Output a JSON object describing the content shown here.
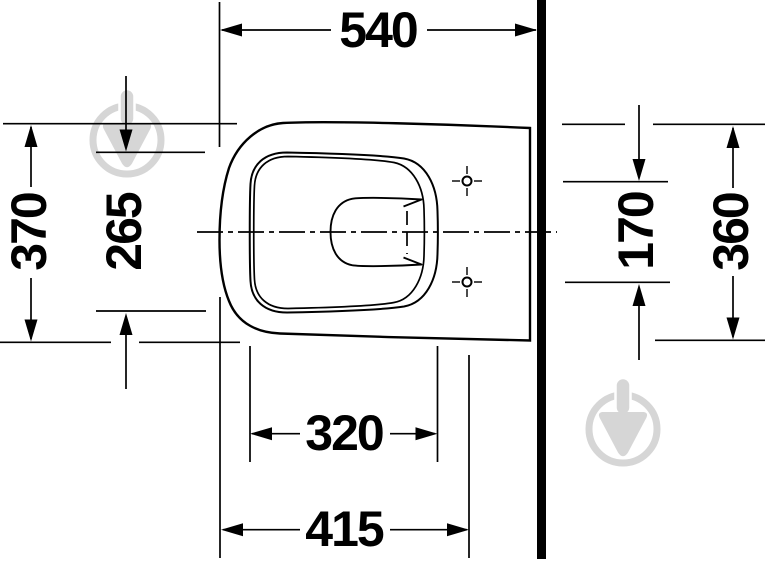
{
  "diagram": {
    "background_color": "#ffffff",
    "line_color": "#000000",
    "watermark_color": "#d6d6d6",
    "watermark_icon": "store-pin-logo-watermark",
    "dimensions": {
      "top_width": "540",
      "left_depth_outer": "370",
      "left_depth_inner": "265",
      "fixing_holes_spacing": "170",
      "right_depth": "360",
      "bottom_width_inner": "320",
      "bottom_width_outer": "415"
    }
  }
}
